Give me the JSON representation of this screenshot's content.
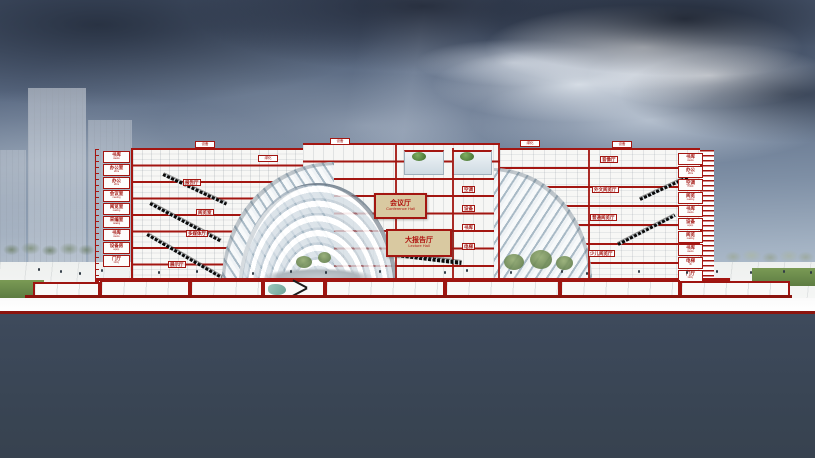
{
  "scene": {
    "title": "Cultural center cross-section rendering",
    "setting": "storm-sky"
  },
  "colors": {
    "cut_red": "#a31611",
    "base_line_red": "#8c140e",
    "hall_tan": "#d9c9a1",
    "foreground_slate": "#3b4756",
    "sky_dark": "#4a5870",
    "sky_light": "#c2cdd9"
  },
  "halls": {
    "conference": {
      "zh": "会议厅",
      "en": "Conference Hall"
    },
    "lecture": {
      "zh": "大报告厅",
      "en": "Lecture Hall"
    }
  },
  "left_labels": [
    {
      "zh": "书库",
      "en": "stacks"
    },
    {
      "zh": "办公室",
      "en": "office"
    },
    {
      "zh": "办公",
      "en": "office"
    },
    {
      "zh": "会议室",
      "en": "meeting"
    },
    {
      "zh": "阅览室",
      "en": "reading"
    },
    {
      "zh": "采编室",
      "en": "catalog"
    },
    {
      "zh": "书库",
      "en": "stacks"
    },
    {
      "zh": "设备房",
      "en": "equip."
    },
    {
      "zh": "门厅",
      "en": "lobby"
    }
  ],
  "right_labels": [
    {
      "zh": "书库",
      "en": "stacks"
    },
    {
      "zh": "办公",
      "en": "office"
    },
    {
      "zh": "空调",
      "en": "HVAC"
    },
    {
      "zh": "阅览",
      "en": "reading"
    },
    {
      "zh": "书库",
      "en": "stacks"
    },
    {
      "zh": "设备",
      "en": "equip."
    },
    {
      "zh": "阅览",
      "en": "reading"
    },
    {
      "zh": "书库",
      "en": "stacks"
    },
    {
      "zh": "电梯",
      "en": "lift"
    },
    {
      "zh": "门厅",
      "en": "lobby"
    }
  ],
  "left_rooms": [
    {
      "text": "报告厅"
    },
    {
      "text": "阅览室"
    },
    {
      "text": "多媒体厅"
    },
    {
      "text": "展示厅"
    }
  ],
  "core_rooms": [
    {
      "text": "空调"
    },
    {
      "text": "设备"
    },
    {
      "text": "书库"
    },
    {
      "text": "电梯"
    }
  ],
  "right_rooms": [
    {
      "text": "音像厅"
    },
    {
      "text": "外文阅览厅"
    },
    {
      "text": "普通阅览厅"
    },
    {
      "text": "少儿阅览厅"
    }
  ],
  "roof_units": [
    {
      "text": "设备"
    },
    {
      "text": "绿化"
    },
    {
      "text": "设备"
    },
    {
      "text": "绿化"
    },
    {
      "text": "设备"
    }
  ]
}
